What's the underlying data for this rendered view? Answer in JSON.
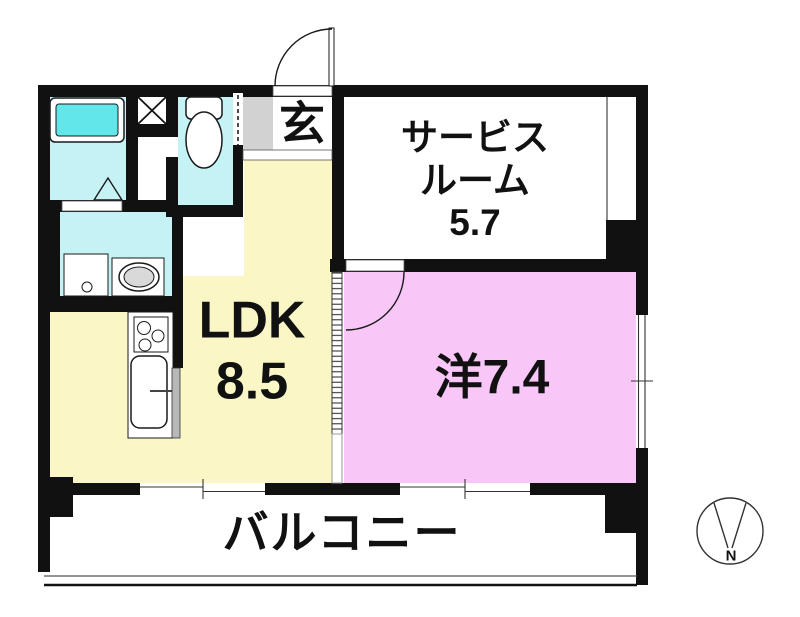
{
  "floor_plan": {
    "labels": {
      "entrance": "玄",
      "service_room": "サービス\nルーム\n5.7",
      "ldk": "LDK\n8.5",
      "western_room": "洋7.4",
      "balcony": "バルコニー",
      "compass_north": "N"
    },
    "room_sizes": {
      "service_room": "5.7",
      "ldk": "8.5",
      "western_room": "7.4"
    },
    "colors": {
      "wall": "#111111",
      "wet_area": "#c5f2f4",
      "bathtub": "#63e6ea",
      "ldk": "#faf6c6",
      "western_room": "#f9c7f7",
      "entrance_floor": "#d2d2d2",
      "fixture_gray": "#d9d9d9"
    }
  }
}
